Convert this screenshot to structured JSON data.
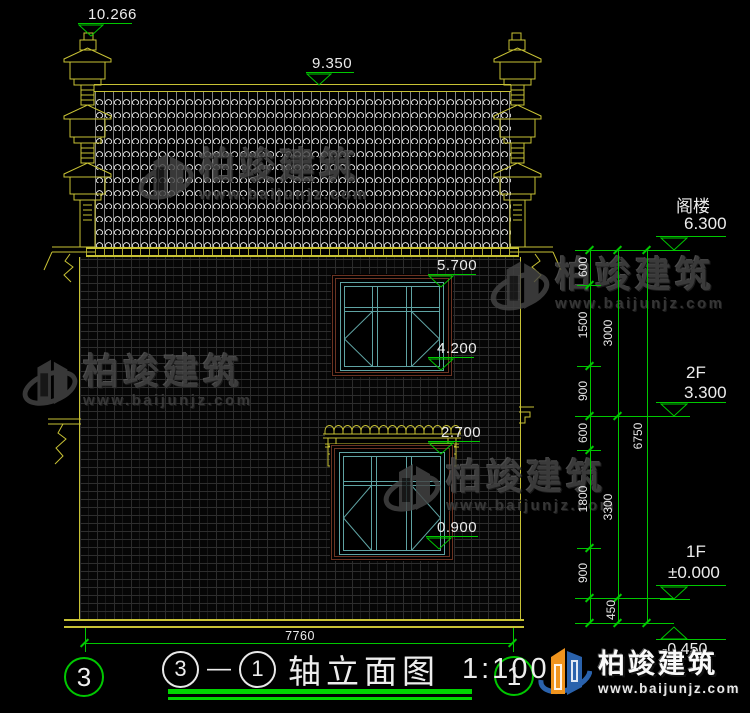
{
  "elevation_markers": {
    "top_left": "10.266",
    "ridge": "9.350",
    "win2_top": "5.700",
    "win2_bottom": "4.200",
    "win1_top": "2.700",
    "win1_bottom": "0.900",
    "attic": {
      "label": "阁楼",
      "value": "6.300"
    },
    "f2": {
      "label": "2F",
      "value": "3.300"
    },
    "f1": {
      "label": "1F",
      "value": "±0.000"
    },
    "base": {
      "value": "-0.450"
    }
  },
  "dims": {
    "chain1": [
      "600",
      "1500",
      "900",
      "600",
      "1800",
      "900",
      "450"
    ],
    "chain2": [
      "3000",
      "3300"
    ],
    "chain3": [
      "6750"
    ],
    "total_width": "7760"
  },
  "axis_bubbles": {
    "left": "3",
    "right": "1"
  },
  "title": {
    "from": "3",
    "dash": "—",
    "to": "1",
    "name": "轴立面图",
    "scale": "1:100"
  },
  "watermark": {
    "name": "柏竣建筑",
    "url": "www.baijunjz.com"
  },
  "brand": {
    "name": "柏竣建筑",
    "url": "www.baijunjz.com"
  },
  "colors": {
    "dimension_green": "#00c800",
    "architecture_yellow": "#c8c235",
    "window_frame_cyan": "#5fa3a3",
    "window_surround_brown": "#6b3322",
    "brand_orange": "#f0941e",
    "brand_blue": "#2a62ac"
  }
}
